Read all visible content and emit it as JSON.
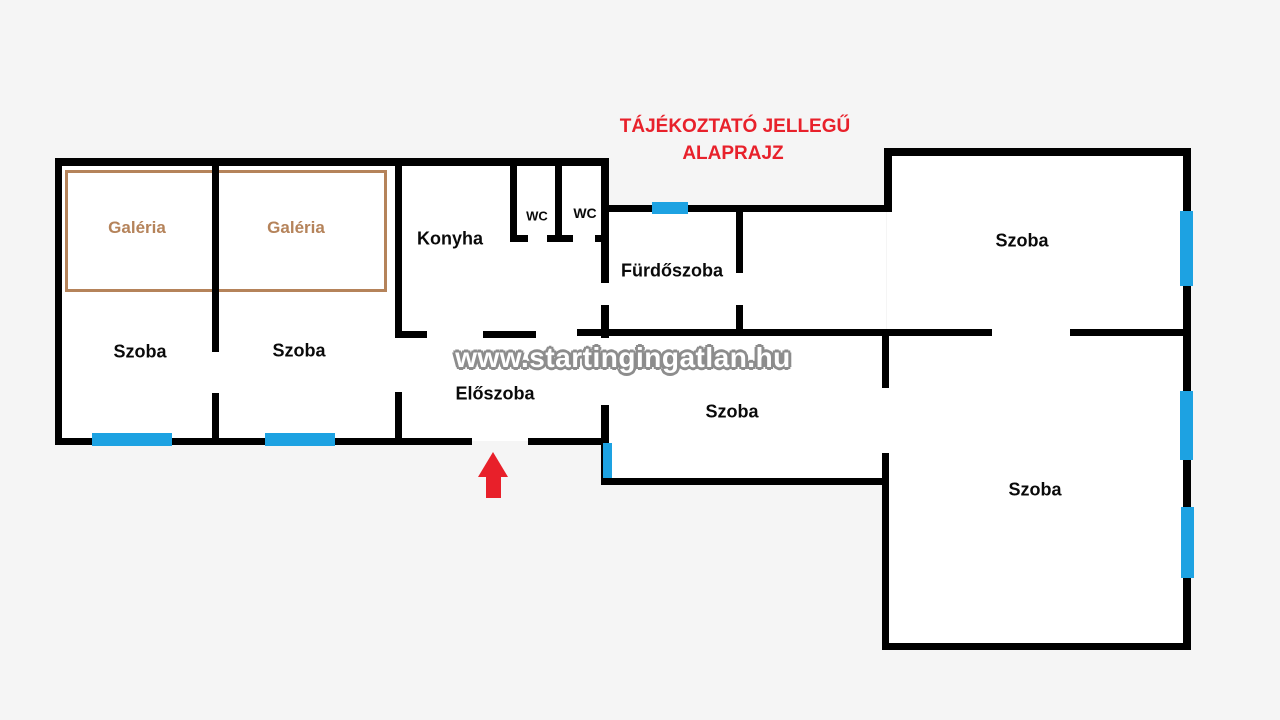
{
  "header": {
    "line1": "TÁJÉKOZTATÓ JELLEGŰ",
    "line2": "ALAPRAJZ"
  },
  "watermark": "www.startingingatlan.hu",
  "room_labels": {
    "galeria_left": "Galéria",
    "galeria_right": "Galéria",
    "szoba_left": "Szoba",
    "szoba_mid_left": "Szoba",
    "konyha": "Konyha",
    "wc_left": "WC",
    "wc_right": "WC",
    "furdoszoba": "Fürdőszoba",
    "eloszoba": "Előszoba",
    "szoba_top_right": "Szoba",
    "szoba_middle": "Szoba",
    "szoba_bottom_right": "Szoba"
  },
  "icons": {
    "entrance_arrow": "red-up-arrow"
  },
  "colors": {
    "wall": "#000000",
    "window": "#1da2e2",
    "gallery": "#b5835a",
    "title_red": "#e8212b",
    "arrow_red": "#e8202a",
    "background": "#f5f5f5",
    "room_fill": "#ffffff",
    "watermark_gray": "#8d8d8d"
  }
}
